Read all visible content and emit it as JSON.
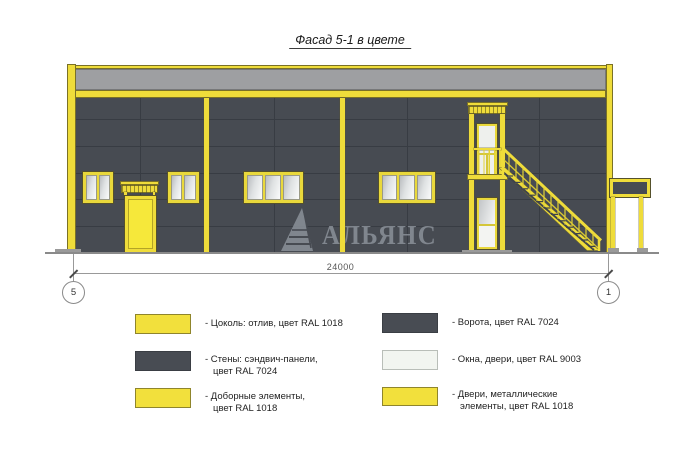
{
  "title": "Фасад 5-1 в цвете",
  "watermark": {
    "brand": "АЛЬЯНС"
  },
  "dimension": {
    "length_label": "24000",
    "axis_left": "5",
    "axis_right": "1"
  },
  "legend": {
    "items": [
      {
        "color": "#F2E03C",
        "line1": "- Цоколь: отлив, цвет RAL 1018",
        "line2": ""
      },
      {
        "color": "#484C53",
        "line1": "- Стены: сэндвич-панели,",
        "line2": "цвет RAL 7024"
      },
      {
        "color": "#F2E03C",
        "line1": "- Доборные элементы,",
        "line2": "цвет RAL 1018"
      },
      {
        "color": "#484C53",
        "line1": "- Ворота, цвет RAL 7024",
        "line2": ""
      },
      {
        "color": "#F2F5F0",
        "line1": "- Окна, двери, цвет RAL 9003",
        "line2": ""
      },
      {
        "color": "#F2E03C",
        "line1": "- Двери, металлические",
        "line2": "элементы, цвет RAL 1018"
      }
    ]
  },
  "colors": {
    "ral1018_yellow": "#F2E03C",
    "ral7024_wall_gray": "#474B52",
    "ral9003_white": "#F2F5F0",
    "parapet_gray": "#9E9FA2"
  }
}
